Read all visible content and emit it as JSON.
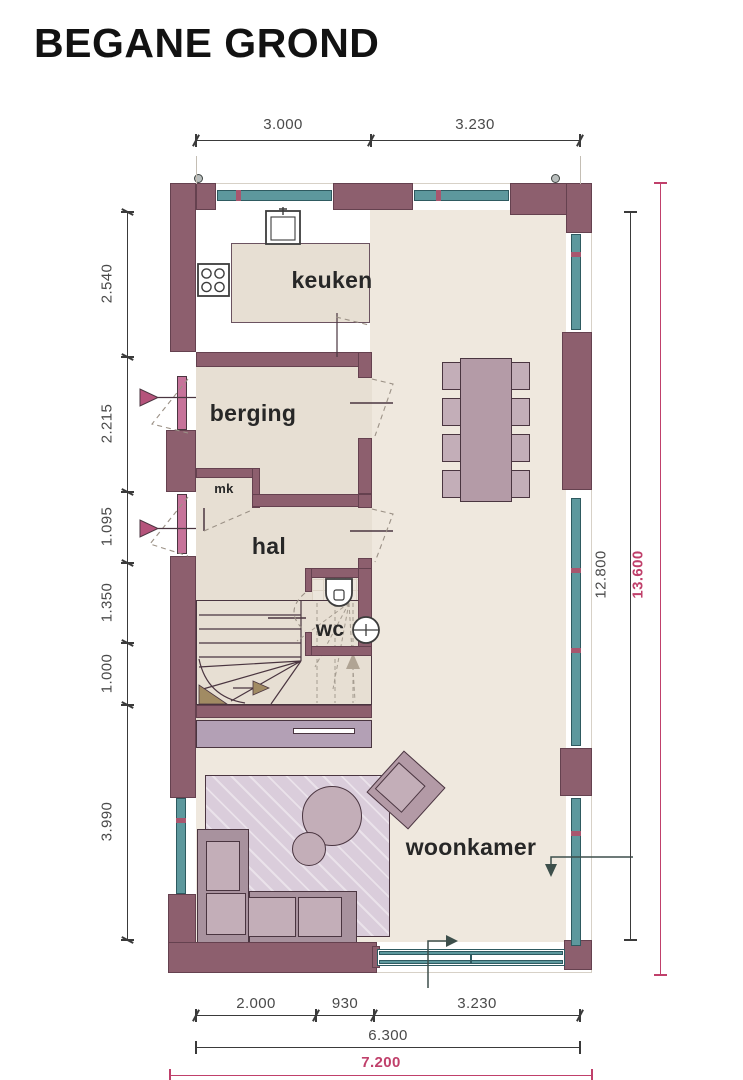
{
  "title": "BEGANE GROND",
  "rooms": {
    "keuken": "keuken",
    "berging": "berging",
    "mk": "mk",
    "hal": "hal",
    "wc": "wc",
    "woonkamer": "woonkamer"
  },
  "dimensions": {
    "top": [
      "3.000",
      "3.230"
    ],
    "left": [
      "2.540",
      "2.215",
      "1.095",
      "1.350",
      "1.000",
      "3.990"
    ],
    "right_inner": "12.800",
    "right_outer": "13.600",
    "bottom_segments": [
      "2.000",
      "930",
      "3.230"
    ],
    "bottom_total": "6.300",
    "bottom_overall": "7.200"
  },
  "colors": {
    "wall": "#8d5f6e",
    "window_glass": "#5d989d",
    "window_mullion": "#a8566e",
    "door_leaf": "#c6739a",
    "floor_room": "#e7dfd3",
    "floor_open": "#efe8de",
    "furniture": "#b49ba7",
    "furniture_light": "#c3aeb8",
    "rug": "#dacddb",
    "dimension_ink": "#3a3a3a",
    "dimension_accent": "#c0406b",
    "entry_arrow": "#b5537b"
  },
  "icons": {
    "sink": "square-basin",
    "cooktop": "four-burners",
    "toilet": "wc-pan",
    "washbasin": "round-basin",
    "entry_arrow": "filled-triangle-right",
    "door_swing": "dashed-arc",
    "vent": "small-circle"
  }
}
